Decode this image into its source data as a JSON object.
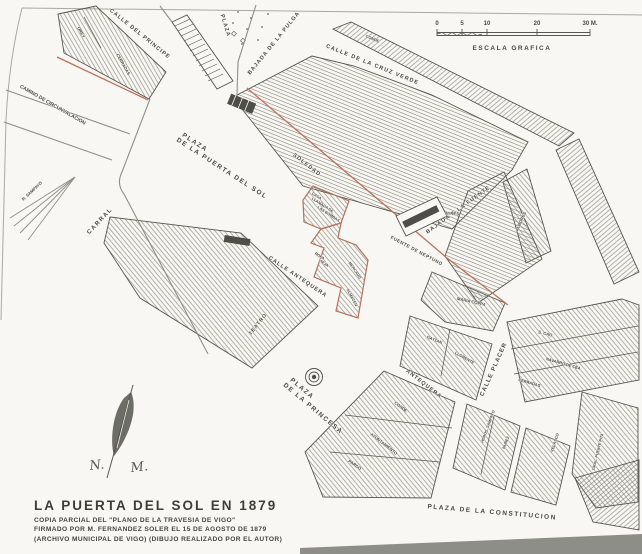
{
  "map": {
    "colors": {
      "paper": "#f8f7f3",
      "ink": "#56564f",
      "accent_red": "#bd7258"
    },
    "title_block": {
      "title": "LA PUERTA DEL SOL EN 1879",
      "line1": "COPIA PARCIAL DEL \"PLANO DE LA TRAVESIA DE VIGO\"",
      "line2": "FIRMADO POR M. FERNANDEZ SOLER EL 15 DE AGOSTO DE 1879",
      "line3": "(ARCHIVO MUNICIPAL DE VIGO)    (DIBUJO REALIZADO POR EL AUTOR)"
    },
    "scale_bar": {
      "caption": "ESCALA GRAFICA",
      "ticks": [
        {
          "label": "0",
          "x": 437
        },
        {
          "label": "5",
          "x": 462
        },
        {
          "label": "10",
          "x": 487
        },
        {
          "label": "20",
          "x": 537
        },
        {
          "label": "30 M.",
          "x": 590
        }
      ]
    },
    "compass": {
      "n": "N.",
      "m": "M."
    },
    "street_labels": [
      {
        "text": "CALLE DEL PRINCIPE",
        "x": 139,
        "y": 35,
        "rot": 39,
        "size": 5.5,
        "ls": 1
      },
      {
        "text": "BAJADA DE LA PULGA",
        "x": 275,
        "y": 44,
        "rot": -51,
        "size": 5.5,
        "ls": 1
      },
      {
        "text": "CALLE DE LA CRUZ VERDE",
        "x": 372,
        "y": 66,
        "rot": 22,
        "size": 5.5,
        "ls": 1.2
      },
      {
        "text": "CAMINO DE CIRCUNVALACION",
        "x": 52,
        "y": 106,
        "rot": 30,
        "size": 5
      },
      {
        "text": "SOLEDAD",
        "x": 306,
        "y": 166,
        "rot": 38,
        "size": 5.5,
        "ls": 1
      },
      {
        "text": "BAJADA A LA FUENTE",
        "x": 459,
        "y": 211,
        "rot": -36,
        "size": 5.5,
        "ls": 1
      },
      {
        "text": "FUENTE DE NEPTUNO",
        "x": 416,
        "y": 252,
        "rot": 28,
        "size": 4.6,
        "ls": 0.5
      },
      {
        "text": "CARRAL",
        "x": 101,
        "y": 222,
        "rot": -47,
        "size": 6,
        "ls": 1.5
      },
      {
        "text": "CALLE ANTEQUERA",
        "x": 297,
        "y": 278,
        "rot": 34,
        "size": 5.5,
        "ls": 1
      },
      {
        "text": "CALLE PLACER",
        "x": 495,
        "y": 370,
        "rot": -66,
        "size": 6,
        "ls": 1
      },
      {
        "text": "ANTEQUERA",
        "x": 423,
        "y": 385,
        "rot": 38,
        "size": 5.5,
        "ls": 1
      },
      {
        "text": "PLAZA DE LA CONSTITUCION",
        "x": 492,
        "y": 514,
        "rot": 5,
        "size": 6.5,
        "ls": 1.5
      }
    ],
    "plaza_labels": [
      {
        "text": "PLAZA",
        "x": 224,
        "y": 26,
        "rot": 73,
        "size": 5.5,
        "ls": 1
      },
      {
        "text": "PLAZA",
        "x": 194,
        "y": 144,
        "rot": 33,
        "size": 6.5,
        "ls": 1.5
      },
      {
        "text": "DE LA PUERTA DEL SOL",
        "x": 221,
        "y": 170,
        "rot": 33,
        "size": 6.5,
        "ls": 1.5
      },
      {
        "text": "PLAZA",
        "x": 301,
        "y": 390,
        "rot": 40,
        "size": 6.5,
        "ls": 1.5
      },
      {
        "text": "DE LA PRINCESA",
        "x": 312,
        "y": 410,
        "rot": 40,
        "size": 6.5,
        "ls": 1.5
      }
    ],
    "parcel_labels": [
      {
        "text": "OREY",
        "x": 80,
        "y": 33,
        "rot": 60,
        "size": 4.2
      },
      {
        "text": "CERRADAS",
        "x": 122,
        "y": 65,
        "rot": 60,
        "size": 4.2
      },
      {
        "text": "CONDE",
        "x": 372,
        "y": 40,
        "rot": 22,
        "size": 4
      },
      {
        "text": "CASA",
        "x": 316,
        "y": 197,
        "rot": 33,
        "size": 3.8
      },
      {
        "text": "LLAMADA DE",
        "x": 322,
        "y": 206,
        "rot": 33,
        "size": 3.8
      },
      {
        "text": "LAS BOMBAS",
        "x": 328,
        "y": 215,
        "rot": 33,
        "size": 3.8
      },
      {
        "text": "ROPA",
        "x": 319,
        "y": 257,
        "rot": 33,
        "size": 3.8
      },
      {
        "text": "VIEJA",
        "x": 323,
        "y": 264,
        "rot": 33,
        "size": 3.8
      },
      {
        "text": "MERCADO",
        "x": 354,
        "y": 271,
        "rot": 55,
        "size": 3.8
      },
      {
        "text": "ALMACEN",
        "x": 351,
        "y": 298,
        "rot": 62,
        "size": 3.8
      },
      {
        "text": "AYRES",
        "x": 452,
        "y": 215,
        "rot": 4,
        "size": 4.2
      },
      {
        "text": "ALBORES",
        "x": 522,
        "y": 222,
        "rot": -66,
        "size": 4.2
      },
      {
        "text": "R. SAMPAYO",
        "x": 33,
        "y": 192,
        "rot": -43,
        "size": 4.2
      },
      {
        "text": "TEATRO",
        "x": 259,
        "y": 325,
        "rot": -52,
        "size": 5,
        "ls": 1
      },
      {
        "text": "MARIA COPPA",
        "x": 471,
        "y": 303,
        "rot": 13,
        "size": 4.2
      },
      {
        "text": "GAYTAN",
        "x": 434,
        "y": 341,
        "rot": 22,
        "size": 4
      },
      {
        "text": "LLORENTE",
        "x": 464,
        "y": 359,
        "rot": 30,
        "size": 4
      },
      {
        "text": "S. CAO",
        "x": 545,
        "y": 335,
        "rot": 14,
        "size": 4.2
      },
      {
        "text": "NAVARRO DE CEA",
        "x": 563,
        "y": 365,
        "rot": 16,
        "size": 4
      },
      {
        "text": "CERRADAS",
        "x": 529,
        "y": 384,
        "rot": 16,
        "size": 4
      },
      {
        "text": "CONDE",
        "x": 400,
        "y": 408,
        "rot": 38,
        "size": 4.2
      },
      {
        "text": "AYUNTAMIENTO",
        "x": 383,
        "y": 445,
        "rot": 38,
        "size": 4.2
      },
      {
        "text": "PARDO",
        "x": 354,
        "y": 466,
        "rot": 35,
        "size": 4.2
      },
      {
        "text": "HDROS. SAMPAYO",
        "x": 489,
        "y": 427,
        "rot": -70,
        "size": 3.8
      },
      {
        "text": "NUÑEZ",
        "x": 507,
        "y": 443,
        "rot": -70,
        "size": 3.8
      },
      {
        "text": "VELASCO",
        "x": 556,
        "y": 443,
        "rot": -72,
        "size": 4
      },
      {
        "text": "GRAL. PUENTE PITA",
        "x": 599,
        "y": 452,
        "rot": -76,
        "size": 3.8
      }
    ]
  }
}
